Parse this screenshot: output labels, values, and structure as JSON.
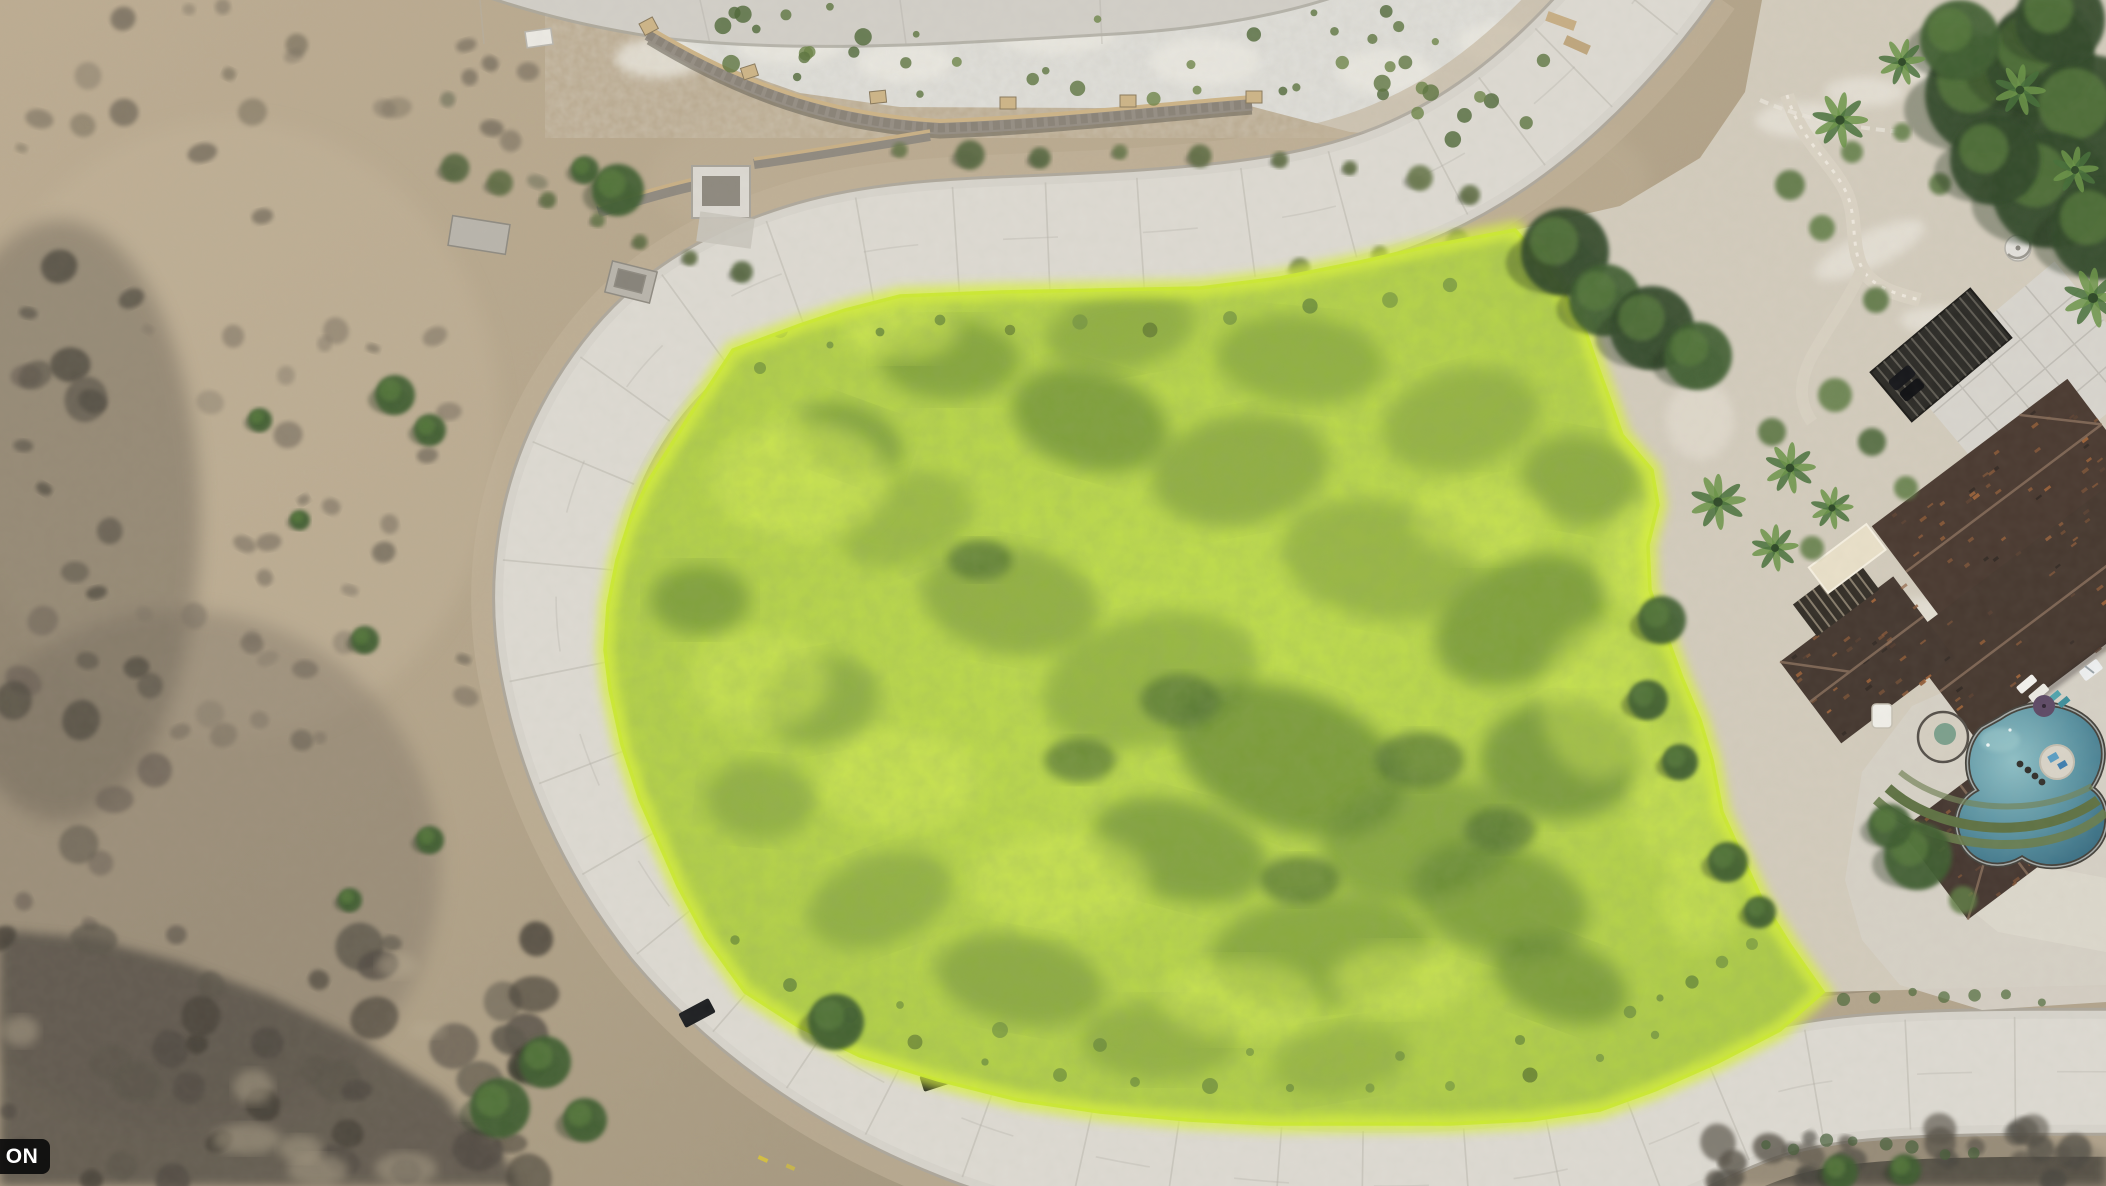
{
  "image": {
    "kind": "aerial-drone-photograph",
    "description": "Top-down drone photo of a vacant hillside lot highlighted in bright chartreuse, wrapped by a curving light-gray concrete road, with dry desert scrub to the left, a white rocky slope and stone retaining wall at top, and a tile-roof estate with swimming pool, spa and palm landscaping on the right",
    "watermark_badge": {
      "text": "ON"
    },
    "colors": {
      "parcel_highlight": "#c8e63a",
      "parcel_rim": "#d9f23e",
      "road": "#d7d4cc",
      "desert": "#b3a289",
      "rocky_slope": "#dad9d3",
      "retaining_wall": "#958e84",
      "roof": "#4a3a31",
      "pool_water": "#4f8b9b",
      "vegetation_dark": "#3f5f33"
    }
  }
}
